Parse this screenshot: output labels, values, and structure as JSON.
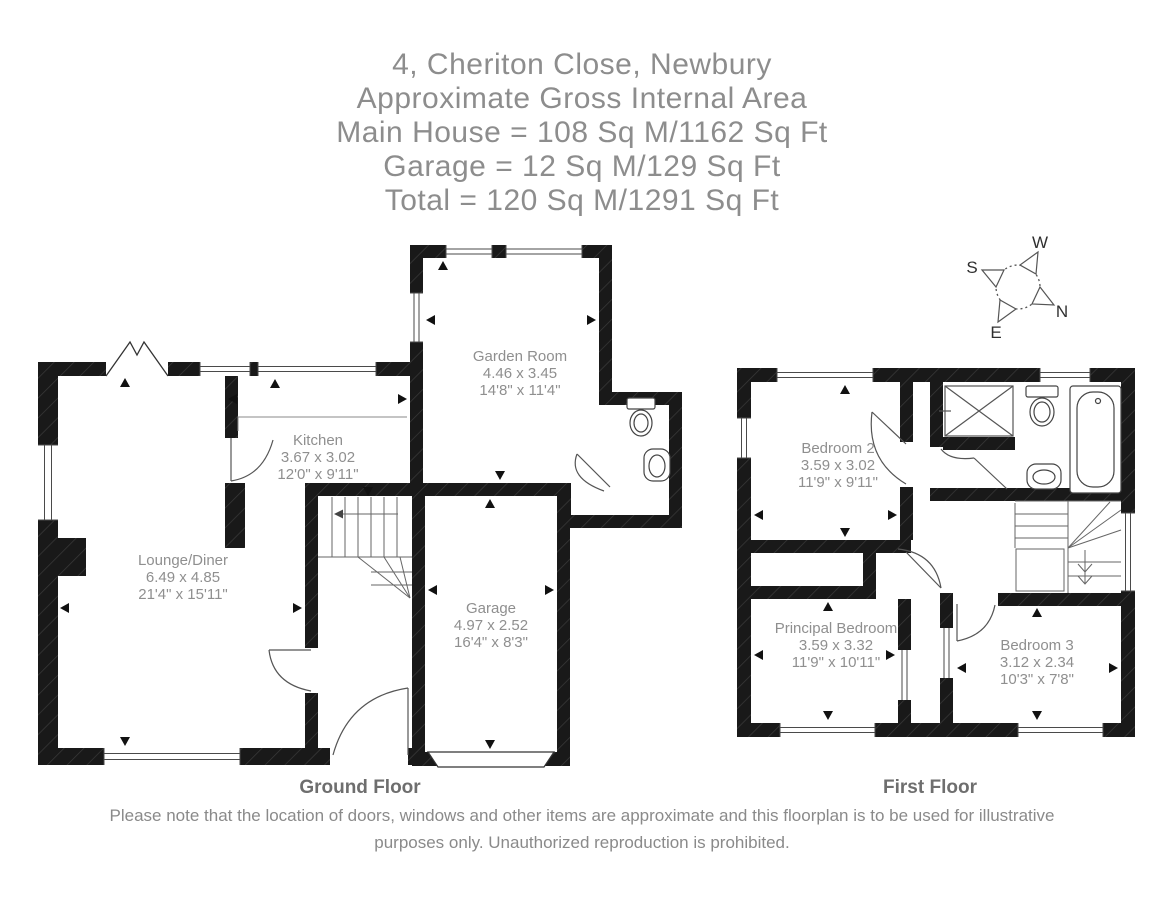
{
  "title": {
    "address": "4, Cheriton Close, Newbury",
    "gia_heading": "Approximate Gross Internal Area",
    "main_house": "Main House = 108 Sq M/1162 Sq Ft",
    "garage": "Garage = 12 Sq M/129 Sq Ft",
    "total": "Total = 120 Sq M/1291 Sq Ft"
  },
  "compass": {
    "n": "N",
    "s": "S",
    "e": "E",
    "w": "W"
  },
  "floors": {
    "ground": {
      "label": "Ground Floor",
      "rooms": {
        "garden_room": {
          "name": "Garden Room",
          "metric": "4.46 x 3.45",
          "imperial": "14'8\" x 11'4\""
        },
        "kitchen": {
          "name": "Kitchen",
          "metric": "3.67 x 3.02",
          "imperial": "12'0\" x 9'11\""
        },
        "lounge_diner": {
          "name": "Lounge/Diner",
          "metric": "6.49 x 4.85",
          "imperial": "21'4\" x 15'11\""
        },
        "garage": {
          "name": "Garage",
          "metric": "4.97 x 2.52",
          "imperial": "16'4\" x 8'3\""
        }
      }
    },
    "first": {
      "label": "First Floor",
      "rooms": {
        "bedroom2": {
          "name": "Bedroom 2",
          "metric": "3.59 x 3.02",
          "imperial": "11'9\" x 9'11\""
        },
        "principal_bedroom": {
          "name": "Principal Bedroom",
          "metric": "3.59 x 3.32",
          "imperial": "11'9\" x 10'11\""
        },
        "bedroom3": {
          "name": "Bedroom 3",
          "metric": "3.12 x 2.34",
          "imperial": "10'3\" x 7'8\""
        }
      }
    }
  },
  "disclaimer": "Please note that the location of doors, windows and other items are approximate and this floorplan is to be used for illustrative purposes only. Unauthorized reproduction is prohibited.",
  "colors": {
    "wall": "#1a1a1a",
    "label_gray": "#8f8f8f",
    "floor_label_gray": "#6e6e6e",
    "fixture_line": "#444444"
  }
}
